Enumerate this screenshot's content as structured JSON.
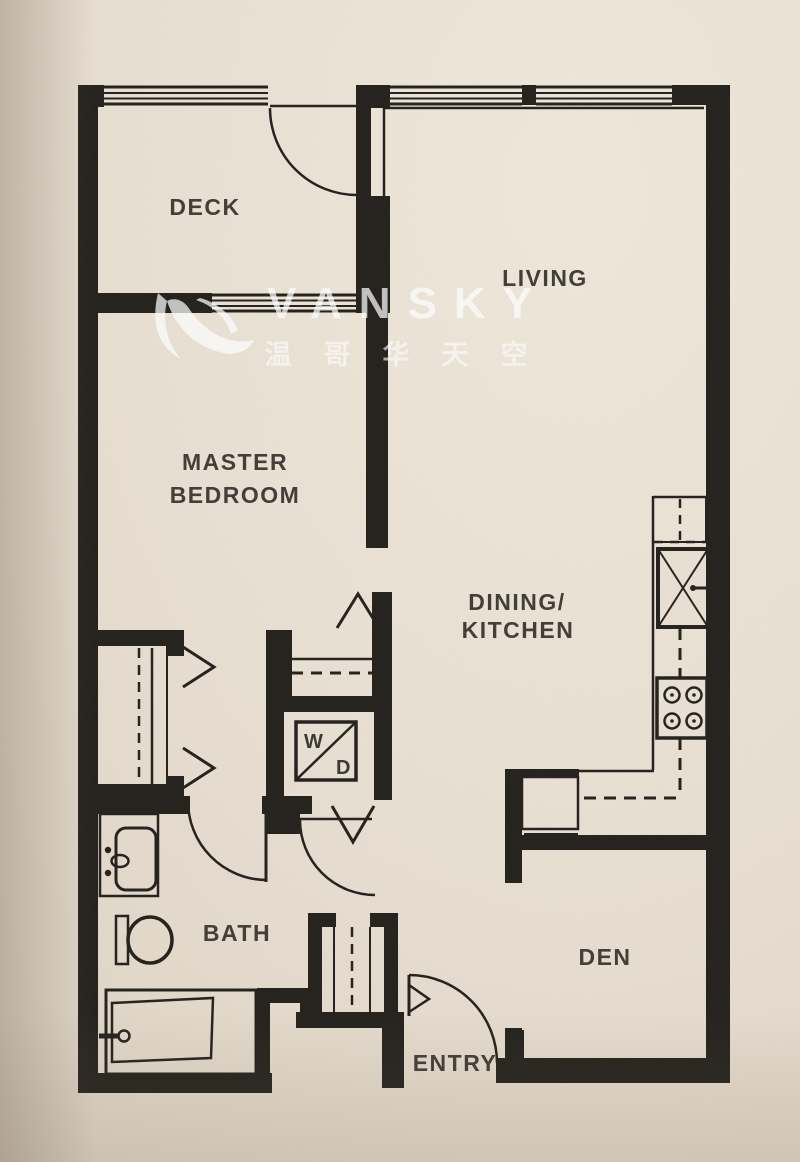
{
  "palette": {
    "paper": "#e8dfd2",
    "ink": "#23201b",
    "label_text": "#403c35",
    "watermark": "#ffffff"
  },
  "watermark": {
    "brand": "VANSKY",
    "tagline_cn": "温哥华天空"
  },
  "rooms": {
    "deck": {
      "label": "DECK"
    },
    "living": {
      "label": "LIVING"
    },
    "master_bedroom": {
      "line1": "MASTER",
      "line2": "BEDROOM"
    },
    "dining_kitchen": {
      "line1": "DINING/",
      "line2": "KITCHEN"
    },
    "bath": {
      "label": "BATH"
    },
    "den": {
      "label": "DEN"
    },
    "entry": {
      "label": "ENTRY"
    }
  },
  "appliances": {
    "washer": "W",
    "dryer": "D"
  }
}
